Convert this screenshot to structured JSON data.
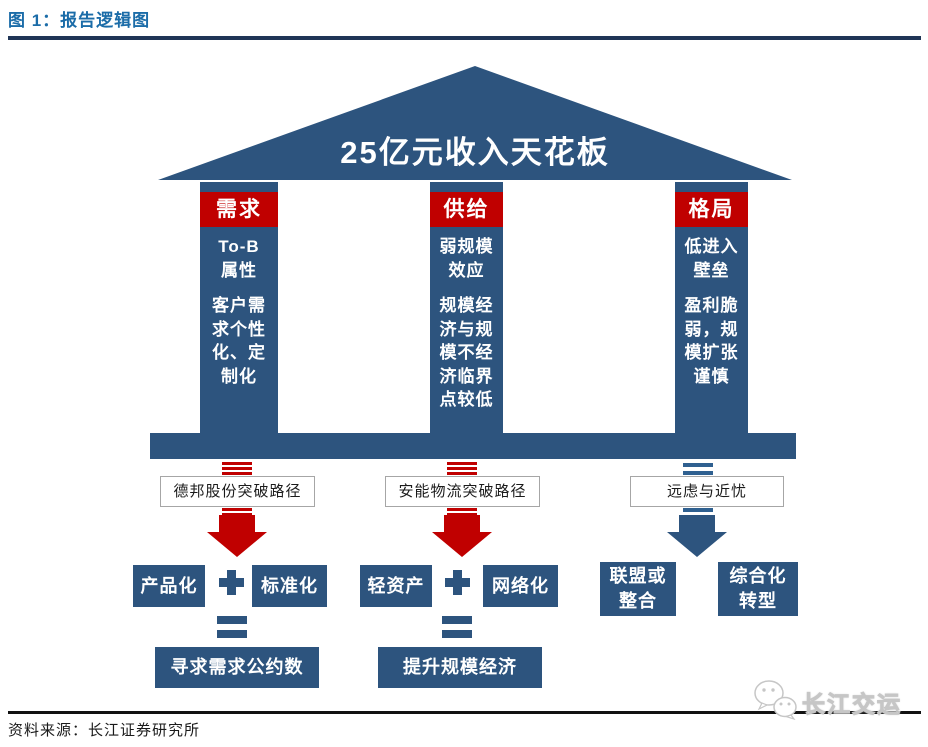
{
  "figure_header": {
    "title": "图 1：报告逻辑图"
  },
  "roof": {
    "label": "25亿元收入天花板"
  },
  "pillars": [
    {
      "header": "需求",
      "lines": [
        "To-B",
        "属性",
        "",
        "客户需",
        "求个性",
        "化、定",
        "制化"
      ]
    },
    {
      "header": "供给",
      "lines": [
        "弱规模",
        "效应",
        "",
        "规模经",
        "济与规",
        "模不经",
        "济临界",
        "点较低"
      ]
    },
    {
      "header": "格局",
      "lines": [
        "低进入",
        "壁垒",
        "",
        "盈利脆",
        "弱，规",
        "模扩张",
        "谨慎"
      ]
    }
  ],
  "path_labels": [
    "德邦股份突破路径",
    "安能物流突破路径",
    "远虑与近忧"
  ],
  "bottom": {
    "g1": {
      "a": "产品化",
      "b": "标准化",
      "result": "寻求需求公约数"
    },
    "g2": {
      "a": "轻资产",
      "b": "网络化",
      "result": "提升规模经济"
    },
    "g3": {
      "a_lines": [
        "联盟或",
        "整合"
      ],
      "b_lines": [
        "综合化",
        "转型"
      ]
    }
  },
  "footer": {
    "source": "资料来源：长江证券研究所",
    "watermark": "长江交运"
  },
  "colors": {
    "pillar_blue": "#2d547e",
    "accent_red": "#c00000",
    "steel_blue": "#2f6090",
    "title_blue": "#1b6ca8",
    "rule_navy": "#1f3556"
  }
}
